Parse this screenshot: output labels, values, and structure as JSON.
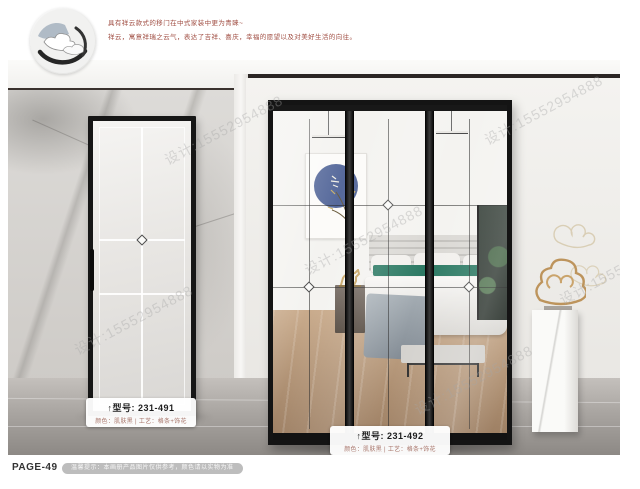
{
  "intro": {
    "line1": "具有祥云款式的移门在中式家装中更为青睐~",
    "line2": "祥云，寓意祥瑞之云气，表达了吉祥、喜庆，幸福的愿望以及对美好生活的向往。"
  },
  "products": [
    {
      "model_label": "↑型号: 231-491",
      "spec": "颜色：肌肤黑 | 工艺：格条+饰花"
    },
    {
      "model_label": "↑型号: 231-492",
      "spec": "颜色：肌肤黑 | 工艺：格条+饰花"
    }
  ],
  "footer": {
    "page_label": "PAGE-49",
    "notice": "温馨提示：本画册产品图片仅供参考，颜色请以实物为准"
  },
  "watermark": {
    "text": "设计:15552954888"
  },
  "colors": {
    "accent_red": "#a14f44",
    "frame_black": "#141414",
    "art_blue": "#56699b",
    "pillow_teal": "#2d7a64",
    "gold": "#c9a86a",
    "marble_gray": "#d6d4d1"
  }
}
